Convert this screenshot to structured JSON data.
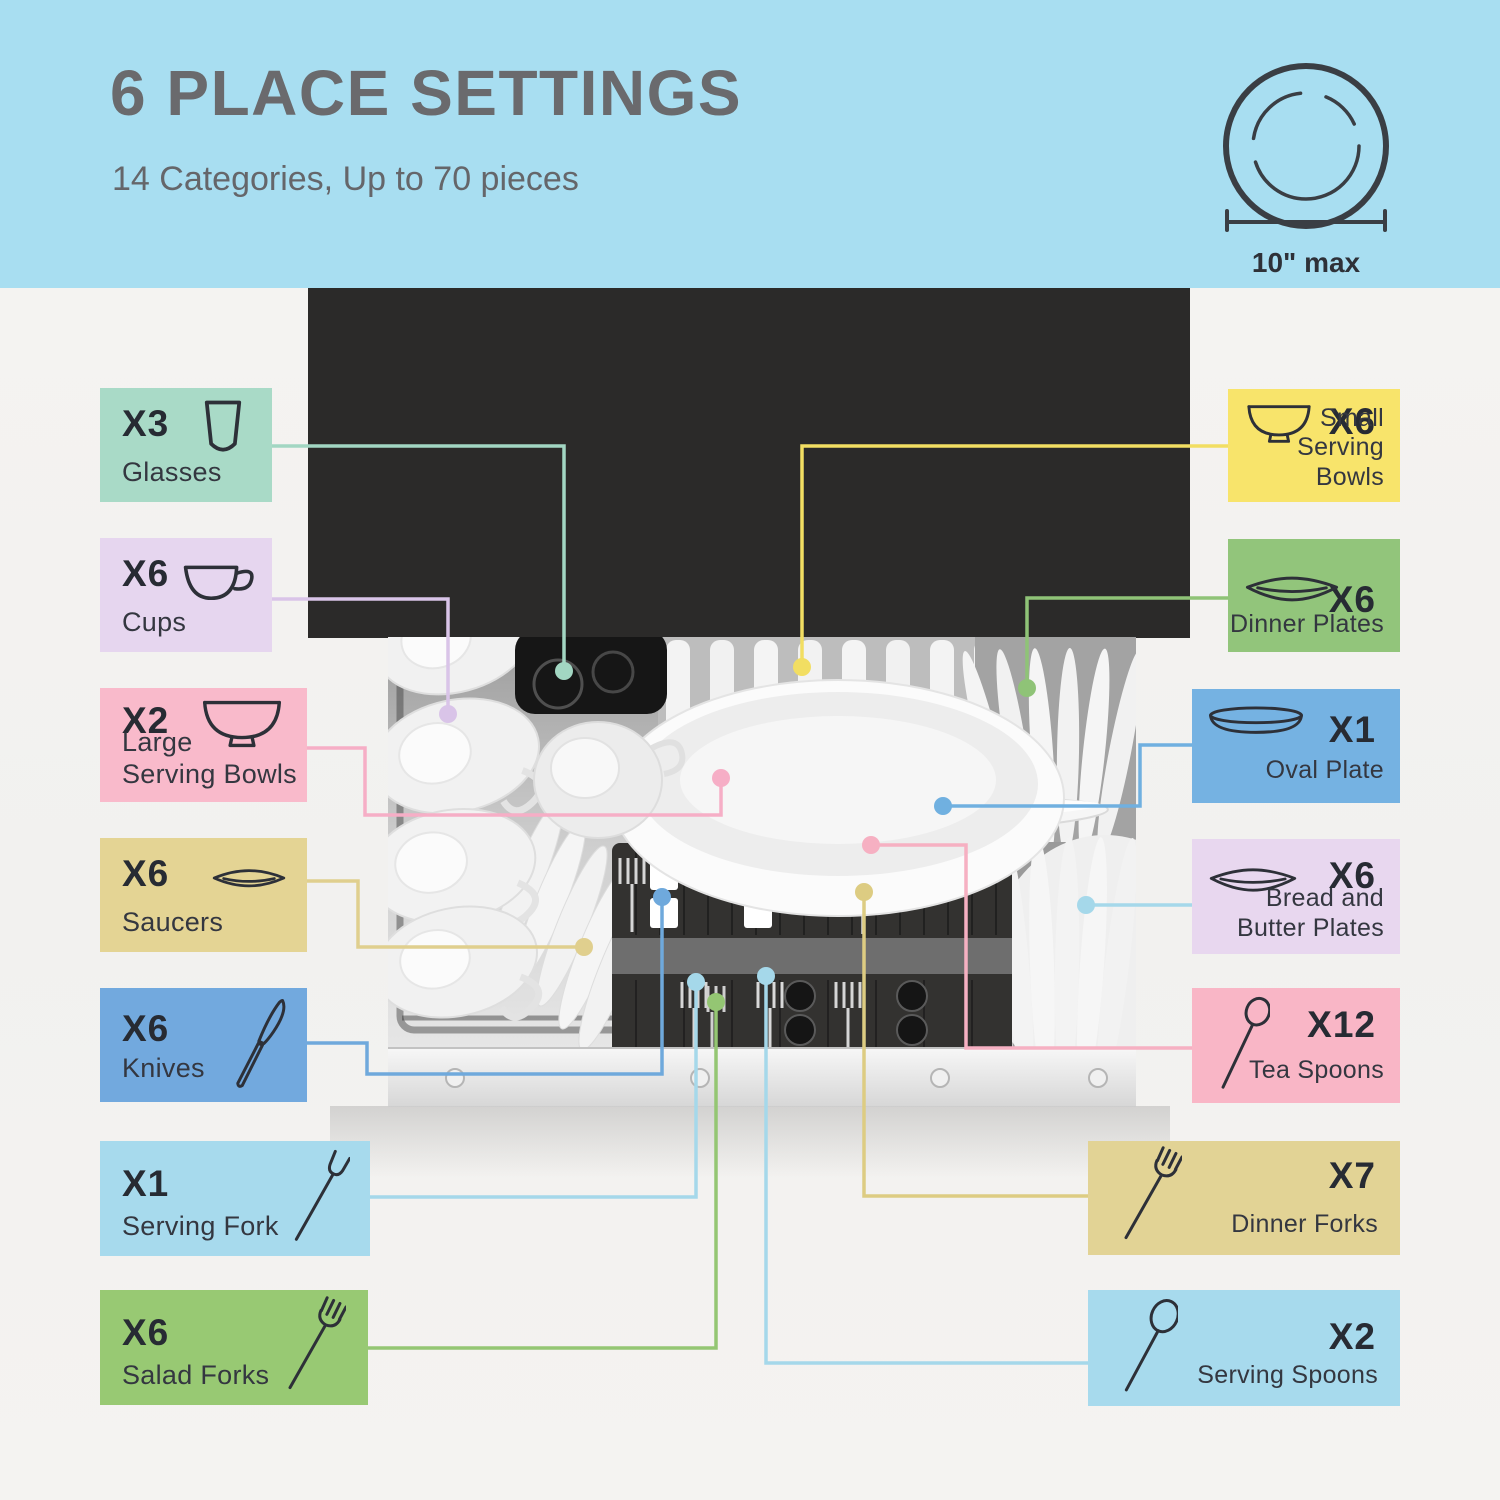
{
  "header": {
    "title": "6 PLACE SETTINGS",
    "subtitle": "14 Categories, Up to 70 pieces",
    "plate_max_label": "10\" max",
    "band_color": "#a8def1"
  },
  "photo": {
    "description": "Top view of a loaded countertop dishwasher",
    "black_panel_color": "#2b2a29"
  },
  "labels": {
    "left": [
      {
        "count": "X3",
        "name": "Glasses",
        "icon": "glass-icon",
        "box_color": "#a9dac7",
        "line_color": "#a2d6c2"
      },
      {
        "count": "X6",
        "name": "Cups",
        "icon": "cup-icon",
        "box_color": "#e6d6ef",
        "line_color": "#d9c4e8"
      },
      {
        "count": "X2",
        "name": "Large\nServing Bowls",
        "icon": "bowl-icon",
        "box_color": "#f9bacb",
        "line_color": "#f6aec6"
      },
      {
        "count": "X6",
        "name": "Saucers",
        "icon": "saucer-icon",
        "box_color": "#e4d494",
        "line_color": "#e0cf8e"
      },
      {
        "count": "X6",
        "name": "Knives",
        "icon": "knife-icon",
        "box_color": "#72a9de",
        "line_color": "#6fa9dc"
      },
      {
        "count": "X1",
        "name": "Serving Fork",
        "icon": "serving-fork-icon",
        "box_color": "#a7daed",
        "line_color": "#a5d8ea"
      },
      {
        "count": "X6",
        "name": "Salad Forks",
        "icon": "fork-icon",
        "box_color": "#98c973",
        "line_color": "#94c673"
      }
    ],
    "right": [
      {
        "count": "X6",
        "name": "Small\nServing Bowls",
        "icon": "bowl-icon",
        "box_color": "#f8e46b",
        "line_color": "#f2de62"
      },
      {
        "count": "X6",
        "name": "Dinner Plates",
        "icon": "plate-icon",
        "box_color": "#92c57b",
        "line_color": "#8fc377"
      },
      {
        "count": "X1",
        "name": "Oval Plate",
        "icon": "oval-plate-icon",
        "box_color": "#75b2e2",
        "line_color": "#70b0e0"
      },
      {
        "count": "X6",
        "name": "Bread and\nButter Plates",
        "icon": "plate-icon",
        "box_color": "#e8d7ef",
        "line_color": "#a5d8ea"
      },
      {
        "count": "X12",
        "name": "Tea Spoons",
        "icon": "spoon-icon",
        "box_color": "#f9b6c6",
        "line_color": "#f6b0c2"
      },
      {
        "count": "X7",
        "name": "Dinner Forks",
        "icon": "fork-icon",
        "box_color": "#e2d395",
        "line_color": "#ddcc82"
      },
      {
        "count": "X2",
        "name": "Serving Spoons",
        "icon": "spoon-icon",
        "box_color": "#a7daed",
        "line_color": "#a5d8ea"
      }
    ]
  }
}
